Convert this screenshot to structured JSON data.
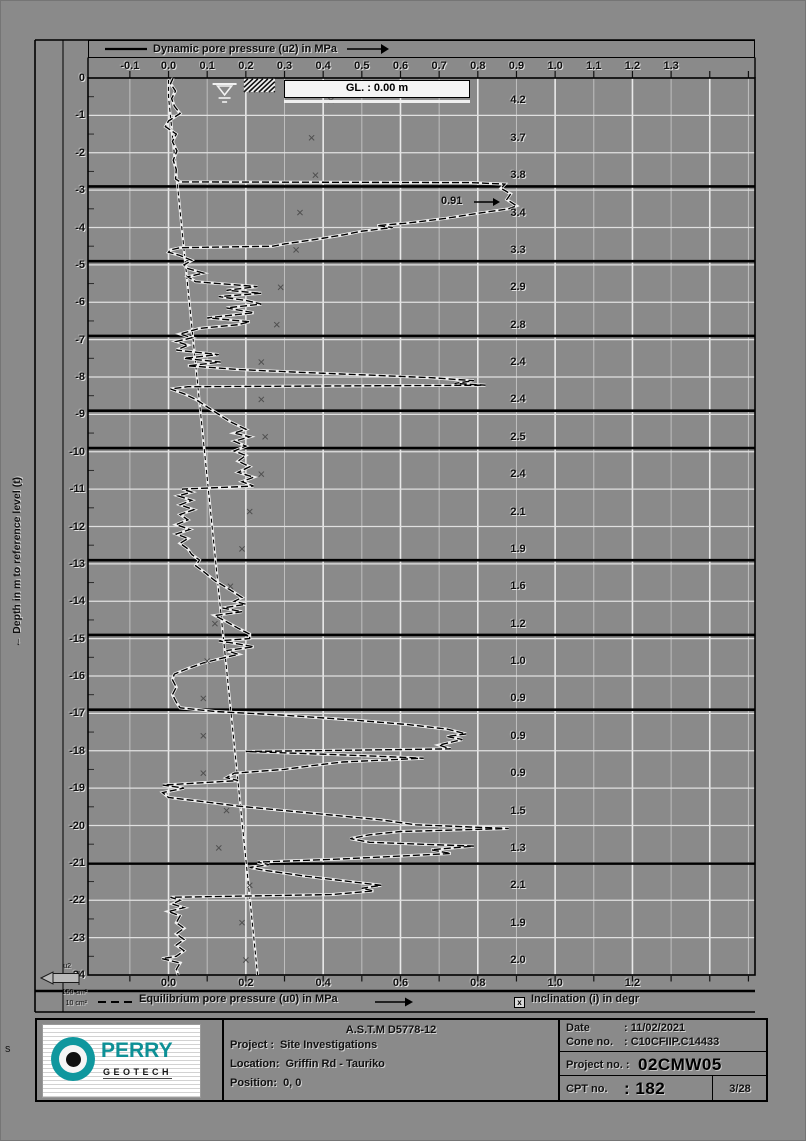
{
  "header": {
    "legend_u2": "Dynamic pore pressure (u2) in MPa"
  },
  "y_axis": {
    "title": "←  Depth in m to reference level (t)"
  },
  "gl_box": {
    "text": "GL. :  0.00  m"
  },
  "annotation_peak": {
    "text": "0.91"
  },
  "bottom_legend": {
    "legend_u0": "Equilibrium pore pressure (u0) in MPa",
    "incl_symbol": "x",
    "legend_incl": "Inclination (i) in degr"
  },
  "cone_symbol": {
    "label": "u2",
    "row1": "150 cm²",
    "row2": "10 cm²"
  },
  "corner_letter": "s",
  "footer": {
    "astm": "A.S.T.M D5778-12",
    "project_label": "Project :",
    "project_value": "Site Investigations",
    "location_label": "Location:",
    "location_value": "Griffin Rd - Tauriko",
    "position_label": "Position:",
    "position_value": "0, 0",
    "date_label": "Date",
    "date_value": ": 11/02/2021",
    "cone_label": "Cone no.",
    "cone_value": ": C10CFIIP.C14433",
    "projectno_label": "Project no. :",
    "projectno_value": "02CMW05",
    "cptno_label": "CPT no.",
    "cptno_value": ": 182",
    "page_number": "3/28",
    "logo_top": "PERRY",
    "logo_bottom": "GEOTECH"
  },
  "chart_data": {
    "type": "line",
    "title": "Dynamic pore pressure (u2) in MPa",
    "xlabel": "Pore pressure in MPa",
    "ylabel": "Depth in m to reference level",
    "x_range": [
      -0.2083,
      1.517
    ],
    "depth_range": [
      0,
      -24
    ],
    "top_tick_labels": [
      -0.1,
      0.0,
      0.1,
      0.2,
      0.3,
      0.4,
      0.5,
      0.6,
      0.7,
      0.8,
      0.9,
      1.0,
      1.1,
      1.2,
      1.3
    ],
    "bottom_tick_labels": [
      0.0,
      0.2,
      0.4,
      0.6,
      0.8,
      1.0,
      1.2
    ],
    "minor_tick_step": 0.1,
    "grid": true,
    "layer_boundaries": [
      -2.9,
      -4.9,
      -6.9,
      -8.9,
      -9.9,
      -12.9,
      -14.9,
      -16.9,
      -21.02
    ],
    "annotations": [
      {
        "text": "0.91",
        "value": 0.91,
        "depth": -3.32
      }
    ],
    "series": [
      {
        "name": "Dynamic pore pressure (u2) in MPa",
        "style": "dashed-black",
        "points": [
          [
            0.012,
            0
          ],
          [
            0.005,
            -0.15
          ],
          [
            0.018,
            -0.35
          ],
          [
            0.008,
            -0.55
          ],
          [
            0.015,
            -0.75
          ],
          [
            0.03,
            -0.95
          ],
          [
            0.0,
            -1.15
          ],
          [
            -0.008,
            -1.3
          ],
          [
            0.02,
            -1.5
          ],
          [
            0.01,
            -1.7
          ],
          [
            0.022,
            -1.95
          ],
          [
            0.012,
            -2.2
          ],
          [
            0.02,
            -2.45
          ],
          [
            0.018,
            -2.7
          ],
          [
            0.03,
            -2.78
          ],
          [
            0.78,
            -2.8
          ],
          [
            0.87,
            -2.84
          ],
          [
            0.86,
            -2.95
          ],
          [
            0.885,
            -3.1
          ],
          [
            0.875,
            -3.25
          ],
          [
            0.9,
            -3.42
          ],
          [
            0.88,
            -3.5
          ],
          [
            0.8,
            -3.62
          ],
          [
            0.72,
            -3.75
          ],
          [
            0.62,
            -3.88
          ],
          [
            0.54,
            -3.95
          ],
          [
            0.58,
            -4.0
          ],
          [
            0.5,
            -4.1
          ],
          [
            0.45,
            -4.2
          ],
          [
            0.38,
            -4.32
          ],
          [
            0.3,
            -4.44
          ],
          [
            0.27,
            -4.5
          ],
          [
            0.03,
            -4.54
          ],
          [
            0.005,
            -4.6
          ],
          [
            0.0,
            -4.66
          ],
          [
            0.03,
            -4.75
          ],
          [
            0.06,
            -4.88
          ],
          [
            0.04,
            -5.0
          ],
          [
            0.05,
            -5.1
          ],
          [
            0.09,
            -5.22
          ],
          [
            0.05,
            -5.32
          ],
          [
            0.07,
            -5.45
          ],
          [
            0.23,
            -5.58
          ],
          [
            0.15,
            -5.68
          ],
          [
            0.24,
            -5.76
          ],
          [
            0.13,
            -5.85
          ],
          [
            0.2,
            -5.95
          ],
          [
            0.24,
            -6.05
          ],
          [
            0.15,
            -6.15
          ],
          [
            0.22,
            -6.28
          ],
          [
            0.1,
            -6.42
          ],
          [
            0.21,
            -6.52
          ],
          [
            0.18,
            -6.6
          ],
          [
            0.08,
            -6.7
          ],
          [
            0.03,
            -6.85
          ],
          [
            0.06,
            -6.95
          ],
          [
            0.02,
            -7.05
          ],
          [
            0.05,
            -7.15
          ],
          [
            0.02,
            -7.28
          ],
          [
            0.13,
            -7.4
          ],
          [
            0.04,
            -7.5
          ],
          [
            0.135,
            -7.6
          ],
          [
            0.05,
            -7.7
          ],
          [
            0.18,
            -7.8
          ],
          [
            0.35,
            -7.88
          ],
          [
            0.52,
            -7.95
          ],
          [
            0.68,
            -8.02
          ],
          [
            0.79,
            -8.1
          ],
          [
            0.74,
            -8.17
          ],
          [
            0.82,
            -8.22
          ],
          [
            0.05,
            -8.26
          ],
          [
            0.005,
            -8.32
          ],
          [
            0.04,
            -8.45
          ],
          [
            0.07,
            -8.6
          ],
          [
            0.1,
            -8.8
          ],
          [
            0.13,
            -9.0
          ],
          [
            0.16,
            -9.2
          ],
          [
            0.2,
            -9.4
          ],
          [
            0.17,
            -9.5
          ],
          [
            0.21,
            -9.6
          ],
          [
            0.17,
            -9.72
          ],
          [
            0.2,
            -9.85
          ],
          [
            0.17,
            -9.98
          ],
          [
            0.2,
            -10.1
          ],
          [
            0.18,
            -10.25
          ],
          [
            0.21,
            -10.4
          ],
          [
            0.18,
            -10.55
          ],
          [
            0.22,
            -10.68
          ],
          [
            0.19,
            -10.8
          ],
          [
            0.22,
            -10.92
          ],
          [
            0.035,
            -11.0
          ],
          [
            0.06,
            -11.08
          ],
          [
            0.025,
            -11.18
          ],
          [
            0.06,
            -11.3
          ],
          [
            0.03,
            -11.42
          ],
          [
            0.065,
            -11.55
          ],
          [
            0.03,
            -11.68
          ],
          [
            0.05,
            -11.82
          ],
          [
            0.02,
            -11.95
          ],
          [
            0.055,
            -12.08
          ],
          [
            0.02,
            -12.2
          ],
          [
            0.05,
            -12.32
          ],
          [
            0.03,
            -12.45
          ],
          [
            0.05,
            -12.6
          ],
          [
            0.06,
            -12.75
          ],
          [
            0.08,
            -12.9
          ],
          [
            0.07,
            -13.05
          ],
          [
            0.09,
            -13.2
          ],
          [
            0.12,
            -13.45
          ],
          [
            0.16,
            -13.7
          ],
          [
            0.19,
            -13.9
          ],
          [
            0.17,
            -14.0
          ],
          [
            0.2,
            -14.08
          ],
          [
            0.14,
            -14.18
          ],
          [
            0.19,
            -14.28
          ],
          [
            0.12,
            -14.38
          ],
          [
            0.15,
            -14.55
          ],
          [
            0.18,
            -14.72
          ],
          [
            0.21,
            -14.88
          ],
          [
            0.21,
            -15.0
          ],
          [
            0.13,
            -15.06
          ],
          [
            0.18,
            -15.14
          ],
          [
            0.22,
            -15.22
          ],
          [
            0.15,
            -15.32
          ],
          [
            0.18,
            -15.42
          ],
          [
            0.14,
            -15.52
          ],
          [
            0.09,
            -15.65
          ],
          [
            0.05,
            -15.8
          ],
          [
            0.015,
            -15.95
          ],
          [
            0.01,
            -16.1
          ],
          [
            0.02,
            -16.3
          ],
          [
            0.01,
            -16.5
          ],
          [
            0.02,
            -16.7
          ],
          [
            0.03,
            -16.85
          ],
          [
            0.12,
            -16.95
          ],
          [
            0.3,
            -17.05
          ],
          [
            0.48,
            -17.18
          ],
          [
            0.62,
            -17.3
          ],
          [
            0.72,
            -17.42
          ],
          [
            0.77,
            -17.55
          ],
          [
            0.72,
            -17.62
          ],
          [
            0.76,
            -17.7
          ],
          [
            0.7,
            -17.85
          ],
          [
            0.73,
            -17.95
          ],
          [
            0.2,
            -18.02
          ],
          [
            0.42,
            -18.1
          ],
          [
            0.55,
            -18.15
          ],
          [
            0.66,
            -18.2
          ],
          [
            0.45,
            -18.3
          ],
          [
            0.37,
            -18.4
          ],
          [
            0.3,
            -18.5
          ],
          [
            0.17,
            -18.6
          ],
          [
            0.15,
            -18.72
          ],
          [
            0.18,
            -18.8
          ],
          [
            -0.015,
            -18.92
          ],
          [
            0.04,
            -19.0
          ],
          [
            -0.015,
            -19.12
          ],
          [
            0.0,
            -19.25
          ],
          [
            0.08,
            -19.35
          ],
          [
            0.18,
            -19.48
          ],
          [
            0.3,
            -19.6
          ],
          [
            0.42,
            -19.72
          ],
          [
            0.55,
            -19.85
          ],
          [
            0.64,
            -19.98
          ],
          [
            0.88,
            -20.08
          ],
          [
            0.6,
            -20.16
          ],
          [
            0.52,
            -20.25
          ],
          [
            0.47,
            -20.35
          ],
          [
            0.52,
            -20.45
          ],
          [
            0.79,
            -20.55
          ],
          [
            0.68,
            -20.65
          ],
          [
            0.73,
            -20.75
          ],
          [
            0.44,
            -20.9
          ],
          [
            0.23,
            -20.98
          ],
          [
            0.26,
            -21.05
          ],
          [
            0.21,
            -21.12
          ],
          [
            0.25,
            -21.2
          ],
          [
            0.35,
            -21.35
          ],
          [
            0.47,
            -21.5
          ],
          [
            0.55,
            -21.6
          ],
          [
            0.5,
            -21.68
          ],
          [
            0.53,
            -21.75
          ],
          [
            0.42,
            -21.85
          ],
          [
            0.005,
            -21.92
          ],
          [
            0.03,
            -22.0
          ],
          [
            0.01,
            -22.1
          ],
          [
            0.04,
            -22.2
          ],
          [
            0.0,
            -22.3
          ],
          [
            0.03,
            -22.42
          ],
          [
            0.02,
            -22.6
          ],
          [
            0.04,
            -22.75
          ],
          [
            0.02,
            -22.9
          ],
          [
            0.04,
            -23.05
          ],
          [
            0.02,
            -23.2
          ],
          [
            0.04,
            -23.35
          ],
          [
            0.02,
            -23.5
          ],
          [
            -0.017,
            -23.56
          ],
          [
            0.03,
            -23.68
          ],
          [
            0.02,
            -23.85
          ],
          [
            0.025,
            -24.0
          ]
        ]
      },
      {
        "name": "Equilibrium pore pressure (u0) in MPa",
        "style": "dashed-fine",
        "points": [
          [
            0.0,
            -0.05
          ],
          [
            0.0,
            -0.5
          ],
          [
            0.2305,
            -24
          ]
        ]
      },
      {
        "name": "Inclination (i) in degr",
        "style": "x-markers",
        "note": "plotted at value/10 on the MPa axis, one value per metre",
        "values_per_meter": [
          4.2,
          3.7,
          3.8,
          3.4,
          3.3,
          2.9,
          2.8,
          2.4,
          2.4,
          2.5,
          2.4,
          2.1,
          1.9,
          1.6,
          1.2,
          1.0,
          0.9,
          0.9,
          0.9,
          1.5,
          1.3,
          2.1,
          1.9,
          2.0
        ]
      }
    ]
  }
}
